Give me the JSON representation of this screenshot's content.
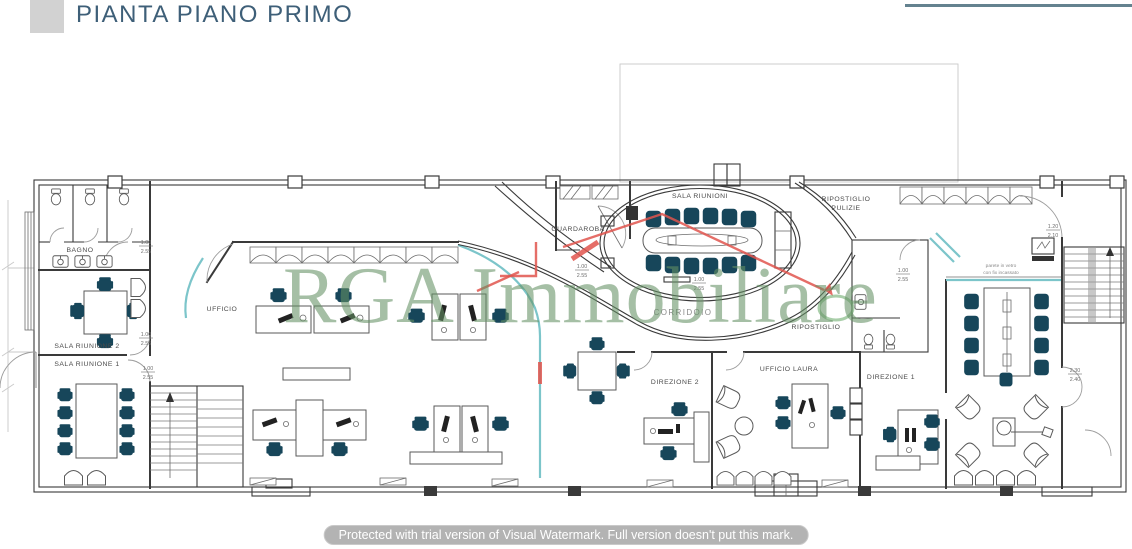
{
  "header": {
    "title": "PIANTA PIANO PRIMO"
  },
  "watermarks": {
    "brand": "RGA Immobiliare",
    "trial_notice": "Protected with trial version of Visual Watermark. Full version doesn't put this mark."
  },
  "rooms": {
    "bagno": "BAGNO",
    "sala_riunione_2": "SALA RIUNIONE 2",
    "sala_riunione_1": "SALA RIUNIONE 1",
    "ufficio": "UFFICIO",
    "guardaroba": "GUARDAROBA",
    "sala_riunioni": "SALA RIUNIONI",
    "corridoio": "CORRIDOIO",
    "ripostiglio_pulizie_line1": "RIPOSTIGLIO",
    "ripostiglio_pulizie_line2": "PULIZIE",
    "ripostiglio": "RIPOSTIGLIO",
    "direzione_2": "DIREZIONE 2",
    "ufficio_laura": "UFFICIO LAURA",
    "direzione_1": "DIREZIONE 1"
  },
  "annotations": {
    "glass_wall_line1": "parete in vetro",
    "glass_wall_line2": "con fix incassato"
  },
  "dims": [
    {
      "a": "1.00",
      "b": "2.55"
    },
    {
      "a": "1.00",
      "b": "2.55"
    },
    {
      "a": "1.00",
      "b": "2.55"
    },
    {
      "a": "1.00",
      "b": "2.55"
    },
    {
      "a": "1.00",
      "b": "2.55"
    },
    {
      "a": "1.20",
      "b": "2.10"
    },
    {
      "a": "2.30",
      "b": "2.40"
    },
    {
      "a": "1.00",
      "b": "2.55"
    }
  ],
  "colors": {
    "title_text": "#3e5f78",
    "accent_wall": "#7cc5ca",
    "furniture_dark": "#17465a",
    "watermark_green": "#6a9a6d",
    "watermark_red": "#e0554e",
    "plan_line": "#3a3a3a"
  }
}
